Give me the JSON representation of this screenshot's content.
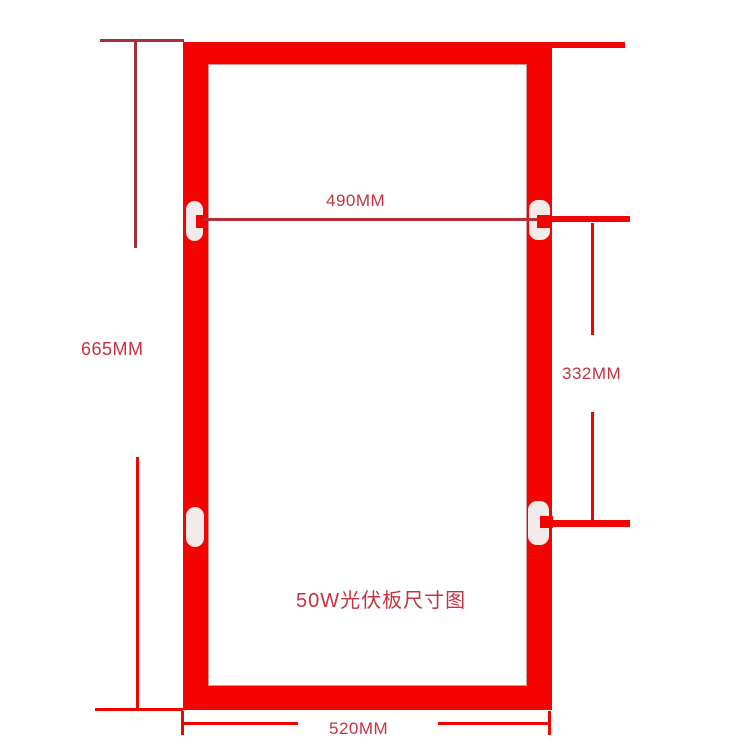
{
  "title": "50W光伏板尺寸图",
  "dimensions": {
    "inner_width": "490MM",
    "overall_height": "665MM",
    "hole_spacing": "332MM",
    "overall_width": "520MM"
  },
  "colors": {
    "frame_red": "#f30400",
    "bright_line": "#f10300",
    "dark_line": "#a03434",
    "dim_line_crimson": "#b13038",
    "label_text": "#c43342",
    "slot_fill": "#f3eaea"
  }
}
